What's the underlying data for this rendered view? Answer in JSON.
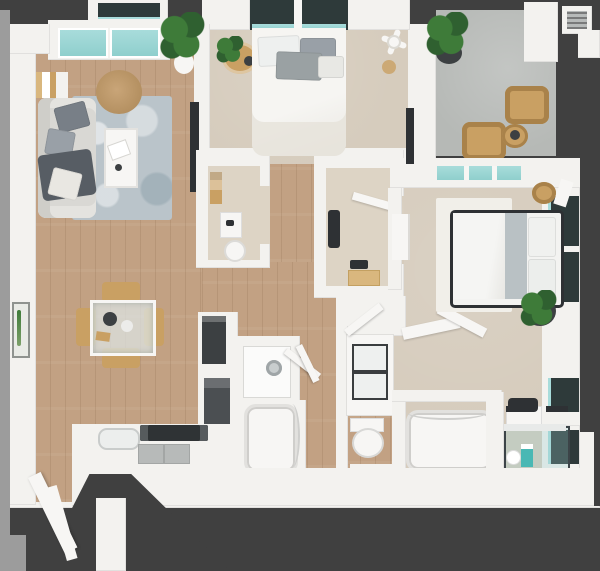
{
  "title": "3D top-down floor plan render — 2 bedroom / 2 bath apartment with balcony",
  "palette": {
    "ext_dark": "#404040",
    "ext_light": "#9c9c9c",
    "wall": "#f3f2ef",
    "white_soft": "#f7f6f4",
    "wood": "#c2a183",
    "carpet": "#d6ccbd",
    "carpet_light": "#ddd4c5",
    "concrete": "#b6b9b6",
    "glass_teal": "#a8dcdb",
    "glass_dark": "#2e3a3a",
    "rug_blue": "#bac4ca",
    "sofa": "#d9d8d4",
    "pillow_gray": "#99a0a7",
    "pillow_dark": "#787f87",
    "throw_dark": "#575d64",
    "tan": "#c9a063",
    "tan_dark": "#a9824a",
    "appliance_dark": "#3c4042",
    "steel": "#b7bab9",
    "plant_green": "#3e7b39",
    "plant_dark_green": "#2f6030",
    "frame_dark": "#2e3134",
    "blanket_gray": "#b9c1c4",
    "teal_bottle": "#49b8b4"
  },
  "rooms": {
    "living_room": {
      "label": "Living room",
      "items": [
        "sofa",
        "throw-pillows",
        "dark-throw-blanket",
        "area-rug",
        "coffee-table",
        "round-ottoman",
        "bookshelf",
        "wall-tv",
        "potted-plant",
        "bay-window"
      ]
    },
    "dining_area": {
      "label": "Dining area",
      "items": [
        "glass-dining-table",
        "four-chairs",
        "place-settings"
      ]
    },
    "kitchen": {
      "label": "Kitchen",
      "items": [
        "l-shaped-counter",
        "refrigerator",
        "oven",
        "cooktop",
        "sink",
        "cabinet-fronts"
      ]
    },
    "entry": {
      "label": "Entry",
      "items": [
        "entry-door",
        "walkway"
      ]
    },
    "bedroom_1": {
      "label": "Bedroom 1",
      "items": [
        "bed",
        "pillows",
        "window",
        "round-side-table",
        "plant",
        "ceiling-fan"
      ]
    },
    "bathroom_1": {
      "label": "Bathroom 1",
      "items": [
        "vanity-sink",
        "toilet",
        "bathtub",
        "washer-dryer-closet",
        "door"
      ]
    },
    "walk_in_closet": {
      "label": "Walk-in closet",
      "items": [
        "hanging-clothes",
        "shoes",
        "storage-box",
        "door"
      ]
    },
    "bedroom_2": {
      "label": "Bedroom 2",
      "items": [
        "bed-dark-frame",
        "gray-blanket",
        "pillows",
        "white-rug",
        "dresser",
        "potted-plant",
        "straw-hat-decor",
        "window-wall",
        "desk"
      ]
    },
    "bathroom_2": {
      "label": "Bathroom 2",
      "items": [
        "double-vanity",
        "toilet",
        "bathtub",
        "glass-shower",
        "shower-bench",
        "toiletries"
      ]
    },
    "balcony": {
      "label": "Balcony",
      "items": [
        "concrete-floor",
        "two-wicker-chairs",
        "round-side-table",
        "potted-plant",
        "vent",
        "column"
      ]
    }
  }
}
